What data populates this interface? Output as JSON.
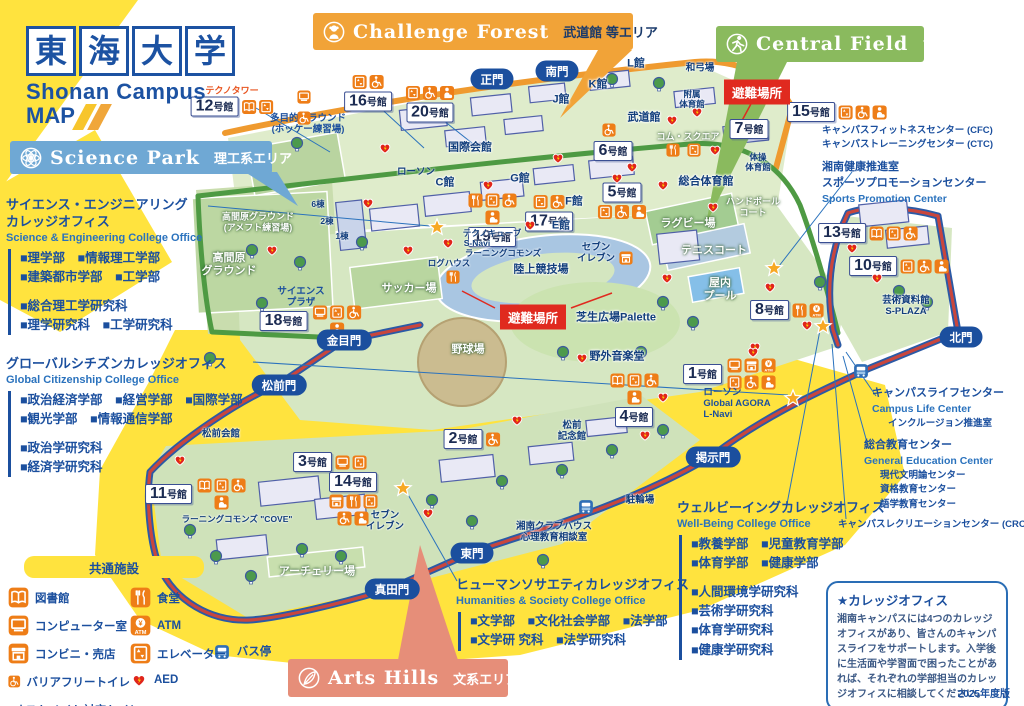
{
  "edition": "2025年度版",
  "shelter_label": "避難場所",
  "building_suffix": "号館",
  "colors": {
    "brand_blue": "#1c52a2",
    "chip_orange": "#ee7d17",
    "alert_red": "#e02a1f",
    "road_red": "#c9463d",
    "road_green": "#4e9a43",
    "road_orange": "#ef9a2f",
    "highlight_yellow": "#ffe33e"
  },
  "logo": {
    "chars": [
      "東",
      "海",
      "大",
      "学"
    ],
    "campus": "Shonan Campus",
    "map_word": "MAP"
  },
  "area_banners": [
    {
      "id": "science-park",
      "en": "Science Park",
      "jp": "理工系エリア",
      "color": "#6fa8d4",
      "icon": "atom",
      "x": 10,
      "y": 141,
      "w": 262,
      "h": 33,
      "jp_dark": false
    },
    {
      "id": "challenge-forest",
      "en": "Challenge Forest",
      "jp": "武道館 等エリア",
      "color": "#f1a338",
      "icon": "monkey",
      "x": 313,
      "y": 13,
      "w": 320,
      "h": 37,
      "jp_dark": true
    },
    {
      "id": "central-field",
      "en": "Central Field",
      "jp": "アスレチックエリア",
      "color": "#8aba5e",
      "icon": "runner",
      "x": 716,
      "y": 26,
      "w": 208,
      "h": 36,
      "jp_dark": false
    },
    {
      "id": "arts-hills",
      "en": "Arts Hills",
      "jp": "文系エリア",
      "color": "#e68e79",
      "icon": "feather",
      "x": 288,
      "y": 659,
      "w": 220,
      "h": 38,
      "jp_dark": false
    }
  ],
  "offices": [
    {
      "id": "science-engineering",
      "x": 6,
      "y": 197,
      "title_lines": [
        "サイエンス・エンジニアリング",
        "カレッジオフィス"
      ],
      "en": "Science & Engineering College Office",
      "groups": [
        [
          "■理学部　■情報理工学部",
          "■建築都市学部　■工学部"
        ],
        [
          "■総合理工学研究科",
          "■理学研究科　■工学研究科"
        ]
      ]
    },
    {
      "id": "global-citizenship",
      "x": 6,
      "y": 356,
      "title_lines": [
        "グローバルシチズンカレッジオフィス"
      ],
      "en": "Global Citizenship College Office",
      "groups": [
        [
          "■政治経済学部　■経営学部　■国際学部",
          "■観光学部　■情報通信学部"
        ],
        [
          "■政治学研究科",
          "■経済学研究科"
        ]
      ]
    },
    {
      "id": "humanities-society",
      "x": 456,
      "y": 577,
      "title_lines": [
        "ヒューマンソサエティカレッジオフィス"
      ],
      "en": "Humanities & Society College Office",
      "groups": [
        [
          "■文学部　■文化社会学部　■法学部",
          "■文学研 究科　■法学研究科"
        ]
      ]
    },
    {
      "id": "well-being",
      "x": 677,
      "y": 500,
      "title_lines": [
        "ウェルビーイングカレッジオフィス"
      ],
      "en": "Well-Being College Office",
      "groups": [
        [
          "■教養学部　■児童教育学部",
          "■体育学部　■健康学部"
        ],
        [
          "■人間環境学研究科",
          "■芸術学研究科",
          "■体育学研究科",
          "■健康学研究科"
        ]
      ]
    }
  ],
  "legend": {
    "x": 8,
    "y": 556,
    "title": "共通施設",
    "col1": [
      [
        "book",
        "図書館"
      ],
      [
        "computer",
        "コンピューター室"
      ],
      [
        "store",
        "コンビニ・売店"
      ],
      [
        "wheelchair",
        "バリアフリートイレ"
      ],
      [
        "ostomate",
        "オストメイト対応トイレ"
      ]
    ],
    "col2": [
      [
        "food",
        "食堂"
      ],
      [
        "atm",
        "ATM"
      ],
      [
        "elevator",
        "エレベーター"
      ],
      [
        "aed",
        "AED"
      ]
    ]
  },
  "info_box": {
    "x": 826,
    "y": 581,
    "w": 182,
    "title": "★カレッジオフィス",
    "body": "湘南キャンパスには4つのカレッジオフィスがあり、皆さんのキャンパスライフをサポートします。入学後に生活面や学習面で困ったことがあれば、それぞれの学部担当のカレッジオフィスに相談してください。"
  },
  "gates": [
    {
      "label": "正門",
      "x": 492,
      "y": 79
    },
    {
      "label": "南門",
      "x": 557,
      "y": 71
    },
    {
      "label": "北門",
      "x": 961,
      "y": 337
    },
    {
      "label": "金目門",
      "x": 344,
      "y": 340
    },
    {
      "label": "松前門",
      "x": 279,
      "y": 385
    },
    {
      "label": "東門",
      "x": 472,
      "y": 553
    },
    {
      "label": "真田門",
      "x": 392,
      "y": 589
    },
    {
      "label": "掲示門",
      "x": 713,
      "y": 457
    }
  ],
  "shelters": [
    {
      "x": 757,
      "y": 92
    },
    {
      "x": 533,
      "y": 317
    }
  ],
  "buildings": [
    {
      "num": "12",
      "x": 232,
      "y": 100,
      "tag": "テクノタワー",
      "icons": [
        "book",
        "elevator"
      ],
      "pos": "right"
    },
    {
      "num": "16",
      "x": 368,
      "y": 93,
      "icons": [
        "elevator",
        "wheelchair"
      ],
      "pos": "above"
    },
    {
      "num": "20",
      "x": 430,
      "y": 104,
      "icons": [
        "elevator",
        "wheelchair",
        "ostomate"
      ],
      "pos": "above"
    },
    {
      "num": "19",
      "x": 492,
      "y": 220,
      "icons": [
        "food",
        "elevator",
        "wheelchair",
        "ostomate"
      ],
      "pos": "above"
    },
    {
      "num": "17",
      "x": 549,
      "y": 213,
      "icons": [
        "elevator",
        "wheelchair"
      ],
      "pos": "above"
    },
    {
      "num": "18",
      "x": 312,
      "y": 321,
      "icons": [
        "computer",
        "elevator",
        "wheelchair",
        "ostomate"
      ],
      "pos": "right"
    },
    {
      "num": "13",
      "x": 868,
      "y": 233,
      "icons": [
        "book",
        "elevator",
        "wheelchair"
      ],
      "pos": "right"
    },
    {
      "num": "10",
      "x": 899,
      "y": 266,
      "icons": [
        "elevator",
        "wheelchair",
        "ostomate"
      ],
      "pos": "right"
    },
    {
      "num": "15",
      "x": 837,
      "y": 112,
      "icons": [
        "elevator",
        "wheelchair",
        "ostomate"
      ],
      "pos": "right"
    },
    {
      "num": "7",
      "x": 749,
      "y": 129,
      "icons": [],
      "pos": "right"
    },
    {
      "num": "6",
      "x": 613,
      "y": 151,
      "icons": [],
      "pos": "right"
    },
    {
      "num": "5",
      "x": 622,
      "y": 201,
      "icons": [
        "elevator",
        "wheelchair",
        "ostomate"
      ],
      "pos": "below"
    },
    {
      "num": "8",
      "x": 787,
      "y": 310,
      "icons": [
        "food",
        "atm"
      ],
      "pos": "right"
    },
    {
      "num": "1",
      "x": 731,
      "y": 374,
      "icons": [
        "computer",
        "store",
        "atm",
        "elevator",
        "wheelchair",
        "ostomate"
      ],
      "pos": "right"
    },
    {
      "num": "4",
      "x": 634,
      "y": 400,
      "icons": [
        "book",
        "elevator",
        "wheelchair",
        "ostomate"
      ],
      "pos": "above"
    },
    {
      "num": "2",
      "x": 472,
      "y": 439,
      "icons": [
        "wheelchair"
      ],
      "pos": "right"
    },
    {
      "num": "3",
      "x": 330,
      "y": 462,
      "icons": [
        "computer",
        "elevator"
      ],
      "pos": "right"
    },
    {
      "num": "14",
      "x": 353,
      "y": 499,
      "icons": [
        "store",
        "food",
        "elevator",
        "wheelchair",
        "ostomate"
      ],
      "pos": "below"
    },
    {
      "num": "11",
      "x": 197,
      "y": 494,
      "icons": [
        "book",
        "elevator",
        "wheelchair",
        "ostomate"
      ],
      "pos": "right"
    }
  ],
  "places": [
    {
      "lines": [
        "多目的グラウンド",
        "(ホッケー練習場)"
      ],
      "x": 308,
      "y": 124,
      "v": "blue-sm"
    },
    {
      "lines": [
        "高間原グラウンド",
        "(アメフト練習場)"
      ],
      "x": 258,
      "y": 222,
      "v": "white-sm"
    },
    {
      "lines": [
        "高間原",
        "グラウンド"
      ],
      "x": 229,
      "y": 265,
      "v": "white"
    },
    {
      "lines": [
        "サイエンス",
        "プラザ"
      ],
      "x": 301,
      "y": 297,
      "v": "blue-sm"
    },
    {
      "lines": [
        "国際会館"
      ],
      "x": 470,
      "y": 148,
      "v": "navy"
    },
    {
      "lines": [
        "ローソン"
      ],
      "x": 416,
      "y": 172,
      "v": "navy-sm"
    },
    {
      "lines": [
        "C館"
      ],
      "x": 445,
      "y": 183,
      "v": "navy"
    },
    {
      "lines": [
        "G館"
      ],
      "x": 520,
      "y": 179,
      "v": "navy"
    },
    {
      "lines": [
        "E館"
      ],
      "x": 561,
      "y": 226,
      "v": "navy"
    },
    {
      "lines": [
        "F館"
      ],
      "x": 574,
      "y": 202,
      "v": "navy"
    },
    {
      "lines": [
        "J館"
      ],
      "x": 561,
      "y": 100,
      "v": "navy"
    },
    {
      "lines": [
        "K館"
      ],
      "x": 598,
      "y": 85,
      "v": "navy"
    },
    {
      "lines": [
        "L館"
      ],
      "x": 636,
      "y": 64,
      "v": "navy"
    },
    {
      "lines": [
        "武道館"
      ],
      "x": 644,
      "y": 118,
      "v": "navy"
    },
    {
      "lines": [
        "コム・スクエア"
      ],
      "x": 688,
      "y": 137,
      "v": "white-sm"
    },
    {
      "lines": [
        "附属",
        "体育館"
      ],
      "x": 692,
      "y": 99,
      "v": "navy-xs"
    },
    {
      "lines": [
        "和弓場"
      ],
      "x": 700,
      "y": 68,
      "v": "navy-sm"
    },
    {
      "lines": [
        "体操",
        "体育館"
      ],
      "x": 758,
      "y": 162,
      "v": "navy-xs"
    },
    {
      "lines": [
        "総合体育館"
      ],
      "x": 706,
      "y": 182,
      "v": "navy"
    },
    {
      "lines": [
        "ハンドボール",
        "コート"
      ],
      "x": 753,
      "y": 207,
      "v": "white-sm"
    },
    {
      "lines": [
        "ラグビー場"
      ],
      "x": 688,
      "y": 224,
      "v": "white"
    },
    {
      "lines": [
        "テニスコート"
      ],
      "x": 714,
      "y": 251,
      "v": "white"
    },
    {
      "lines": [
        "屋内",
        "プール"
      ],
      "x": 720,
      "y": 290,
      "v": "white"
    },
    {
      "lines": [
        "芸術資料館",
        "S-PLAZA"
      ],
      "x": 906,
      "y": 306,
      "v": "navy-sm"
    },
    {
      "lines": [
        "陸上競技場"
      ],
      "x": 541,
      "y": 270,
      "v": "navy"
    },
    {
      "lines": [
        "サッカー場"
      ],
      "x": 409,
      "y": 289,
      "v": "white"
    },
    {
      "lines": [
        "野球場"
      ],
      "x": 468,
      "y": 350,
      "v": "white"
    },
    {
      "lines": [
        "芝生広場Palette"
      ],
      "x": 616,
      "y": 318,
      "v": "navy"
    },
    {
      "lines": [
        "野外音楽堂"
      ],
      "x": 617,
      "y": 357,
      "v": "navy"
    },
    {
      "lines": [
        "セブン",
        "イレブン"
      ],
      "x": 596,
      "y": 253,
      "v": "navy-sm"
    },
    {
      "lines": [
        "セブン",
        "イレブン"
      ],
      "x": 385,
      "y": 521,
      "v": "navy-sm"
    },
    {
      "lines": [
        "テクノキューブ"
      ],
      "x": 492,
      "y": 233,
      "v": "navy-xs"
    },
    {
      "lines": [
        "S-Navi"
      ],
      "x": 477,
      "y": 243,
      "v": "navy-xs"
    },
    {
      "lines": [
        "ラーニングコモンズ"
      ],
      "x": 503,
      "y": 253,
      "v": "navy-xs"
    },
    {
      "lines": [
        "ログハウス"
      ],
      "x": 449,
      "y": 263,
      "v": "navy-xs"
    },
    {
      "lines": [
        "松前会館"
      ],
      "x": 221,
      "y": 434,
      "v": "navy-sm"
    },
    {
      "lines": [
        "松前",
        "記念館"
      ],
      "x": 572,
      "y": 431,
      "v": "navy-sm"
    },
    {
      "lines": [
        "湘南クラブハウス",
        "心理教育相談室"
      ],
      "x": 554,
      "y": 532,
      "v": "navy-sm"
    },
    {
      "lines": [
        "アーチェリー場"
      ],
      "x": 317,
      "y": 572,
      "v": "white"
    },
    {
      "lines": [
        "駐輪場"
      ],
      "x": 640,
      "y": 500,
      "v": "navy-sm"
    },
    {
      "lines": [
        "ラーニングコモンズ \"COVE\""
      ],
      "x": 237,
      "y": 519,
      "v": "navy-xs"
    },
    {
      "lines": [
        "バス停"
      ],
      "x": 254,
      "y": 653,
      "v": "blue"
    },
    {
      "lines": [
        "6棟"
      ],
      "x": 318,
      "y": 204,
      "v": "navy-xs"
    },
    {
      "lines": [
        "2棟"
      ],
      "x": 327,
      "y": 221,
      "v": "navy-xs"
    },
    {
      "lines": [
        "1棟"
      ],
      "x": 342,
      "y": 236,
      "v": "navy-xs"
    },
    {
      "lines": [
        "ローソン",
        "Global AGORA",
        "L-Navi"
      ],
      "x": 737,
      "y": 404,
      "v": "blue-sm",
      "align": "left"
    }
  ],
  "annotations": [
    {
      "x": 822,
      "y": 124,
      "lines": [
        [
          "t",
          "キャンパスフィットネスセンター (CFC)"
        ],
        [
          "t",
          "キャンパストレーニングセンター (CTC)"
        ]
      ]
    },
    {
      "x": 822,
      "y": 160,
      "lines": [
        [
          "b",
          "湘南健康推進室"
        ],
        [
          "b",
          "スポーツプロモーションセンター"
        ],
        [
          "e",
          "Sports Promotion Center"
        ]
      ]
    },
    {
      "x": 872,
      "y": 386,
      "lines": [
        [
          "b",
          "キャンパスライフセンター"
        ],
        [
          "e",
          "Campus Life Center"
        ],
        [
          "s",
          "インクルージョン推進室"
        ]
      ]
    },
    {
      "x": 864,
      "y": 438,
      "lines": [
        [
          "b",
          "総合教育センター"
        ],
        [
          "e",
          "General Education Center"
        ],
        [
          "s",
          "現代文明論センター"
        ],
        [
          "s",
          "資格教育センター"
        ],
        [
          "s",
          "語学教育センター"
        ]
      ]
    },
    {
      "x": 838,
      "y": 518,
      "lines": [
        [
          "t",
          "キャンパスレクリエーションセンター (CRC)"
        ]
      ]
    }
  ],
  "map_icons": {
    "stars": [
      [
        437,
        227
      ],
      [
        403,
        488
      ],
      [
        793,
        398
      ],
      [
        774,
        268
      ],
      [
        823,
        326
      ]
    ],
    "bus_stops": [
      [
        222,
        652
      ],
      [
        586,
        507
      ],
      [
        861,
        371
      ]
    ],
    "chips": [
      [
        "computer",
        304,
        97
      ],
      [
        "wheelchair",
        304,
        118
      ],
      [
        "wheelchair",
        609,
        130
      ],
      [
        "food",
        673,
        150
      ],
      [
        "elevator",
        694,
        150
      ],
      [
        "store",
        626,
        258
      ],
      [
        "food",
        453,
        277
      ]
    ],
    "aed": [
      [
        385,
        148
      ],
      [
        368,
        203
      ],
      [
        272,
        250
      ],
      [
        408,
        250
      ],
      [
        448,
        243
      ],
      [
        488,
        185
      ],
      [
        558,
        158
      ],
      [
        617,
        178
      ],
      [
        632,
        167
      ],
      [
        663,
        185
      ],
      [
        672,
        120
      ],
      [
        697,
        112
      ],
      [
        713,
        207
      ],
      [
        715,
        150
      ],
      [
        667,
        278
      ],
      [
        770,
        287
      ],
      [
        807,
        325
      ],
      [
        755,
        347
      ],
      [
        852,
        248
      ],
      [
        877,
        278
      ],
      [
        582,
        358
      ],
      [
        663,
        397
      ],
      [
        753,
        352
      ],
      [
        517,
        420
      ],
      [
        645,
        435
      ],
      [
        180,
        460
      ],
      [
        428,
        513
      ],
      [
        530,
        225
      ]
    ]
  },
  "leader_lines": [
    [
      208,
      206,
      430,
      226
    ],
    [
      253,
      362,
      788,
      395
    ],
    [
      457,
      581,
      406,
      491
    ],
    [
      787,
      504,
      820,
      330
    ],
    [
      876,
      396,
      846,
      352
    ],
    [
      868,
      446,
      843,
      356
    ],
    [
      846,
      519,
      832,
      344
    ],
    [
      852,
      172,
      779,
      266
    ],
    [
      256,
      108,
      330,
      152
    ],
    [
      374,
      102,
      424,
      148
    ],
    [
      434,
      113,
      477,
      147
    ]
  ]
}
